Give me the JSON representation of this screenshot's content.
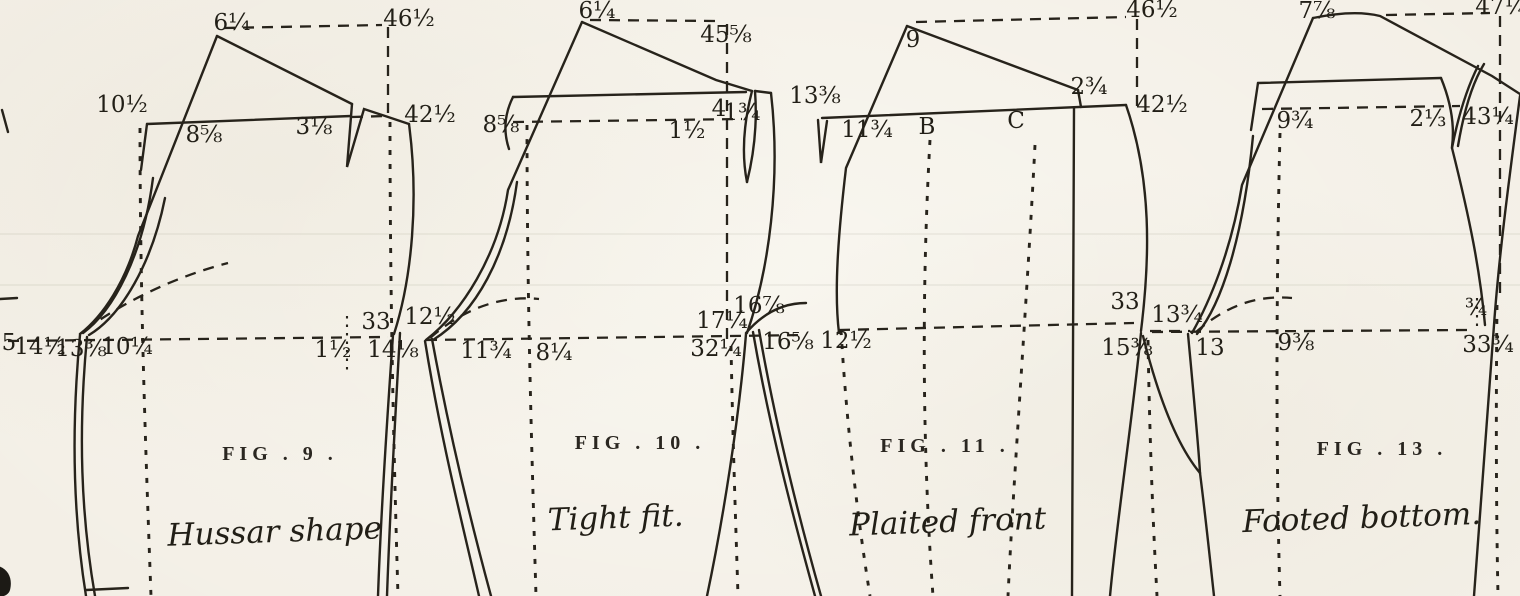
{
  "page": {
    "background": "#f3efe6",
    "ink": "#27231b"
  },
  "figures": [
    {
      "id": "fig-9",
      "title": "FIG . 9 .",
      "caption": "Hussar shape",
      "labels": [
        {
          "t": "6¼",
          "x": 232,
          "y": 30
        },
        {
          "t": "46½",
          "x": 409,
          "y": 26
        },
        {
          "t": "10½",
          "x": 122,
          "y": 112
        },
        {
          "t": "8⅝",
          "x": 204,
          "y": 142
        },
        {
          "t": "3⅛",
          "x": 314,
          "y": 134
        },
        {
          "t": "42½",
          "x": 430,
          "y": 122
        },
        {
          "t": "5",
          "x": 9,
          "y": 350
        },
        {
          "t": "14½",
          "x": 40,
          "y": 354
        },
        {
          "t": "13⅜",
          "x": 81,
          "y": 356
        },
        {
          "t": "10¼",
          "x": 127,
          "y": 354
        },
        {
          "t": "1½",
          "x": 333,
          "y": 357
        },
        {
          "t": "33",
          "x": 376,
          "y": 329
        },
        {
          "t": "14⅛",
          "x": 393,
          "y": 357
        }
      ]
    },
    {
      "id": "fig-10",
      "title": "FIG . 10 .",
      "caption": "Tight fit.",
      "labels": [
        {
          "t": "6¼",
          "x": 597,
          "y": 18
        },
        {
          "t": "45⅝",
          "x": 726,
          "y": 42
        },
        {
          "t": "8⅝",
          "x": 501,
          "y": 132
        },
        {
          "t": "1½",
          "x": 687,
          "y": 138
        },
        {
          "t": "4",
          "x": 719,
          "y": 116,
          "fs": 20
        },
        {
          "t": "1¾",
          "x": 742,
          "y": 120,
          "fs": 20
        },
        {
          "t": "12½",
          "x": 430,
          "y": 324
        },
        {
          "t": "11¾",
          "x": 486,
          "y": 358
        },
        {
          "t": "8¼",
          "x": 554,
          "y": 360
        },
        {
          "t": "17¼",
          "x": 722,
          "y": 328
        },
        {
          "t": "16⅞",
          "x": 759,
          "y": 313,
          "fs": 20
        },
        {
          "t": "32¼",
          "x": 716,
          "y": 356
        },
        {
          "t": "16⅝",
          "x": 788,
          "y": 349
        }
      ]
    },
    {
      "id": "fig-11",
      "title": "FIG . 11 .",
      "caption": "Plaited front",
      "labels": [
        {
          "t": "9",
          "x": 913,
          "y": 47,
          "fs": 27
        },
        {
          "t": "46½",
          "x": 1152,
          "y": 17
        },
        {
          "t": "13⅜",
          "x": 815,
          "y": 103
        },
        {
          "t": "11¾",
          "x": 867,
          "y": 137,
          "fs": 20
        },
        {
          "t": "B",
          "x": 927,
          "y": 134,
          "fs": 31,
          "n": "point-letter-b"
        },
        {
          "t": "C",
          "x": 1016,
          "y": 128,
          "fs": 31,
          "n": "point-letter-c"
        },
        {
          "t": "2¾",
          "x": 1089,
          "y": 94
        },
        {
          "t": "42½",
          "x": 1162,
          "y": 112
        },
        {
          "t": "12½",
          "x": 846,
          "y": 348
        },
        {
          "t": "33",
          "x": 1125,
          "y": 309
        },
        {
          "t": "15⅜",
          "x": 1127,
          "y": 355
        }
      ]
    },
    {
      "id": "fig-13",
      "title": "FIG . 13 .",
      "caption": "Footed bottom.",
      "labels": [
        {
          "t": "13¾",
          "x": 1177,
          "y": 322
        },
        {
          "t": "13",
          "x": 1210,
          "y": 355
        },
        {
          "t": "7⅞",
          "x": 1317,
          "y": 18
        },
        {
          "t": "47¼",
          "x": 1501,
          "y": 14
        },
        {
          "t": "9¾",
          "x": 1295,
          "y": 128
        },
        {
          "t": "2⅓",
          "x": 1428,
          "y": 126
        },
        {
          "t": "43¼",
          "x": 1488,
          "y": 124
        },
        {
          "t": "9⅜",
          "x": 1296,
          "y": 350
        },
        {
          "t": "¾",
          "x": 1476,
          "y": 315,
          "fs": 19
        },
        {
          "t": "33¾",
          "x": 1488,
          "y": 352
        }
      ]
    }
  ]
}
